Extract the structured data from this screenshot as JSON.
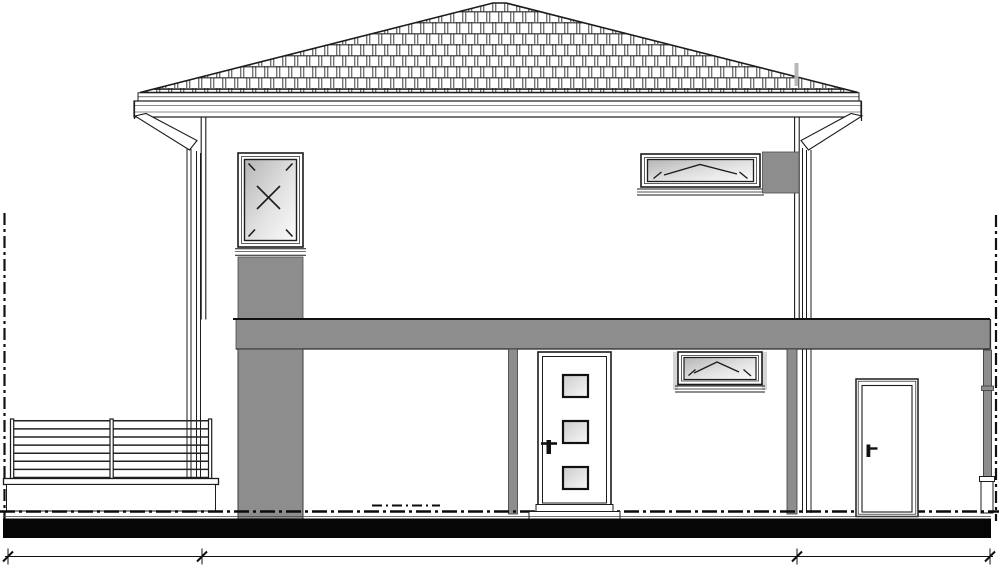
{
  "meta": {
    "drawing_type": "architectural elevation (CAD line drawing)",
    "view": "side elevation of a two-storey house with hipped tile roof and covered porch",
    "visible_text": "none"
  },
  "canvas": {
    "width": 1000,
    "height": 570,
    "background": "#ffffff"
  },
  "colors": {
    "line_dark": "#1c1c1c",
    "line_mid": "#444444",
    "concrete_gray": "#8d8d8d",
    "reveal_gray": "#d6d6d6",
    "ground_black": "#060606",
    "faint_gray": "#b4b4b4",
    "white": "#ffffff"
  },
  "building": {
    "roof": {
      "type": "hipped",
      "covering": "staggered tiles",
      "ridge_x": [
        493,
        506
      ],
      "eave_y": 92
    },
    "gutter": {
      "downspouts": 2
    },
    "upper_floor": {
      "left_window": {
        "symbol": "turn (X) with corner marks",
        "spandrel_panel_below": true
      },
      "right_window": {
        "symbol": "tilt (chevron)",
        "panel_right": true
      }
    },
    "slab_band": {
      "x1": 235,
      "x2": 990,
      "y1": 319,
      "y2": 349
    },
    "ground_floor": {
      "entry_door": {
        "glass_panes": 3,
        "handle": true,
        "threshold_step": true
      },
      "small_window": {
        "symbol": "tilt (chevron)"
      },
      "secondary_door": {
        "glass_panes": 0,
        "handle": true
      },
      "gray_posts": 2,
      "corner_post": {
        "collar": true,
        "pedestal": true
      }
    },
    "railing": {
      "post_count": 3,
      "rail_count": 8,
      "x1": 11,
      "x2": 211,
      "first_rail_y": 420.8,
      "rail_spacing": 8.1,
      "post_x": [
        10.5,
        110,
        208.5
      ],
      "post_y1": 419,
      "post_y2": 478.5
    },
    "site_boundary_lines": 2,
    "ground_line_style": "dash-dot"
  },
  "dimension_line": {
    "y": 556.5,
    "x_start": 5,
    "x_end": 993,
    "tick_positions_px": [
      8,
      202,
      797,
      990
    ],
    "segments": 3,
    "labels": []
  }
}
